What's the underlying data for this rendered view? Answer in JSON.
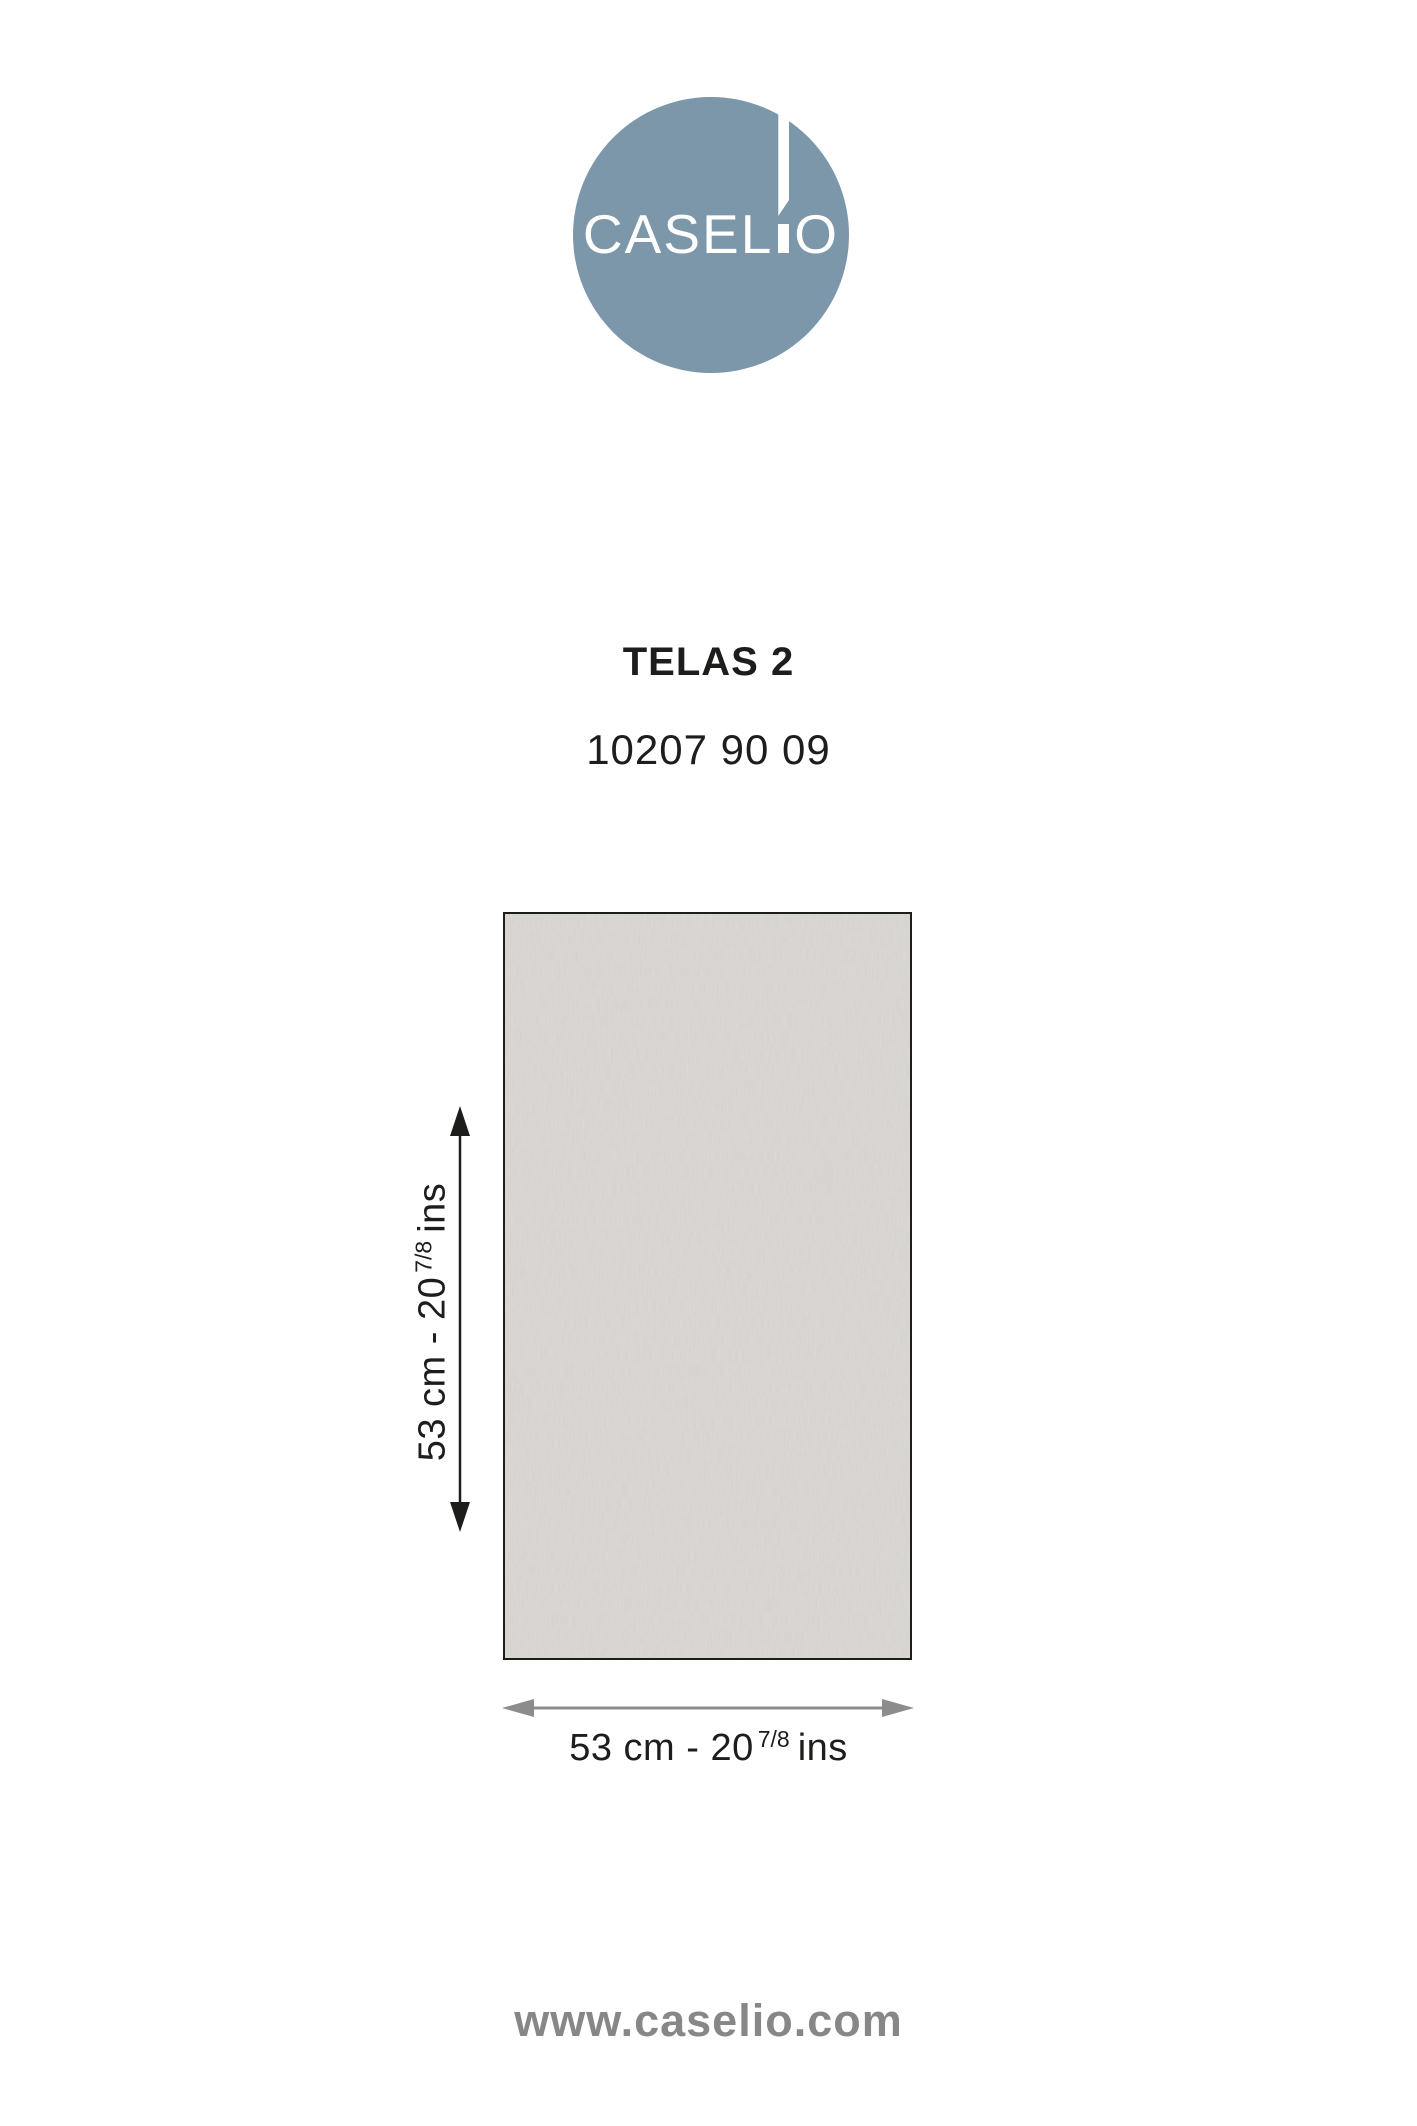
{
  "logo": {
    "brand": "CASELIO",
    "brand_left": "CASEL",
    "brand_right": "O",
    "circle_color": "#7c96aa",
    "text_color": "#ffffff"
  },
  "product": {
    "name": "TELAS 2",
    "reference": "10207 90 09"
  },
  "swatch": {
    "description": "plain woven canvas texture, light grey",
    "base_color": "#d6d3d0",
    "border_color": "#1d1d1b"
  },
  "dimensions": {
    "height": {
      "prefix": "53 cm - 20",
      "fraction": "7/8",
      "suffix": "ins"
    },
    "width": {
      "prefix": "53 cm - 20",
      "fraction": "7/8",
      "suffix": "ins"
    }
  },
  "icons": {
    "height_arrow": "double-headed-vertical-arrow",
    "width_arrow": "double-headed-horizontal-arrow"
  },
  "colors": {
    "ink": "#1d1d1b",
    "vertical_arrow": "#1d1d1b",
    "horizontal_arrow": "#8c8c8c",
    "footer_text": "#878787"
  },
  "footer": {
    "website": "www.caselio.com"
  }
}
